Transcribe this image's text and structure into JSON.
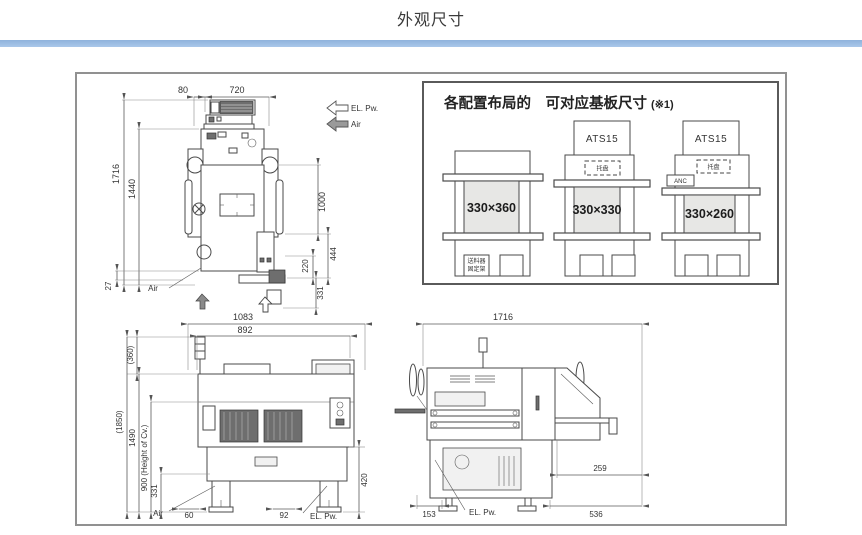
{
  "page": {
    "title": "外观尺寸"
  },
  "colors": {
    "accent_bar": "#aac8ea",
    "box_border": "#919191",
    "shade_fill": "#e7e7e5"
  },
  "top_view": {
    "dim_80": "80",
    "dim_720": "720",
    "dim_1716": "1716",
    "dim_1440": "1440",
    "dim_1000": "1000",
    "dim_444": "444",
    "dim_220": "220",
    "dim_331": "331",
    "dim_27": "27",
    "label_air_leader": "Air",
    "arrow_el_pw": "EL. Pw.",
    "arrow_air": "Air"
  },
  "config_panel": {
    "title": "各配置布局的　可对应基板尺寸",
    "note": "(※1)",
    "configs": [
      {
        "size": "330×360",
        "feeder_line1": "送料器",
        "feeder_line2": "固定架"
      },
      {
        "size": "330×330",
        "ats": "ATS15",
        "tray": "托盘"
      },
      {
        "size": "330×260",
        "ats": "ATS15",
        "tray": "托盘",
        "anc": "ANC"
      }
    ]
  },
  "front_view": {
    "dim_1083": "1083",
    "dim_892": "892",
    "dim_360": "(360)",
    "dim_1850": "(1850)",
    "dim_1490": "1490",
    "dim_900": "900 (Height of Cv.)",
    "dim_331": "331",
    "dim_420": "420",
    "dim_60": "60",
    "dim_92": "92",
    "label_air": "Air",
    "label_el_pw": "EL. Pw."
  },
  "side_view": {
    "dim_1716": "1716",
    "dim_259": "259",
    "dim_153": "153",
    "dim_536": "536",
    "label_el_pw": "EL. Pw."
  }
}
